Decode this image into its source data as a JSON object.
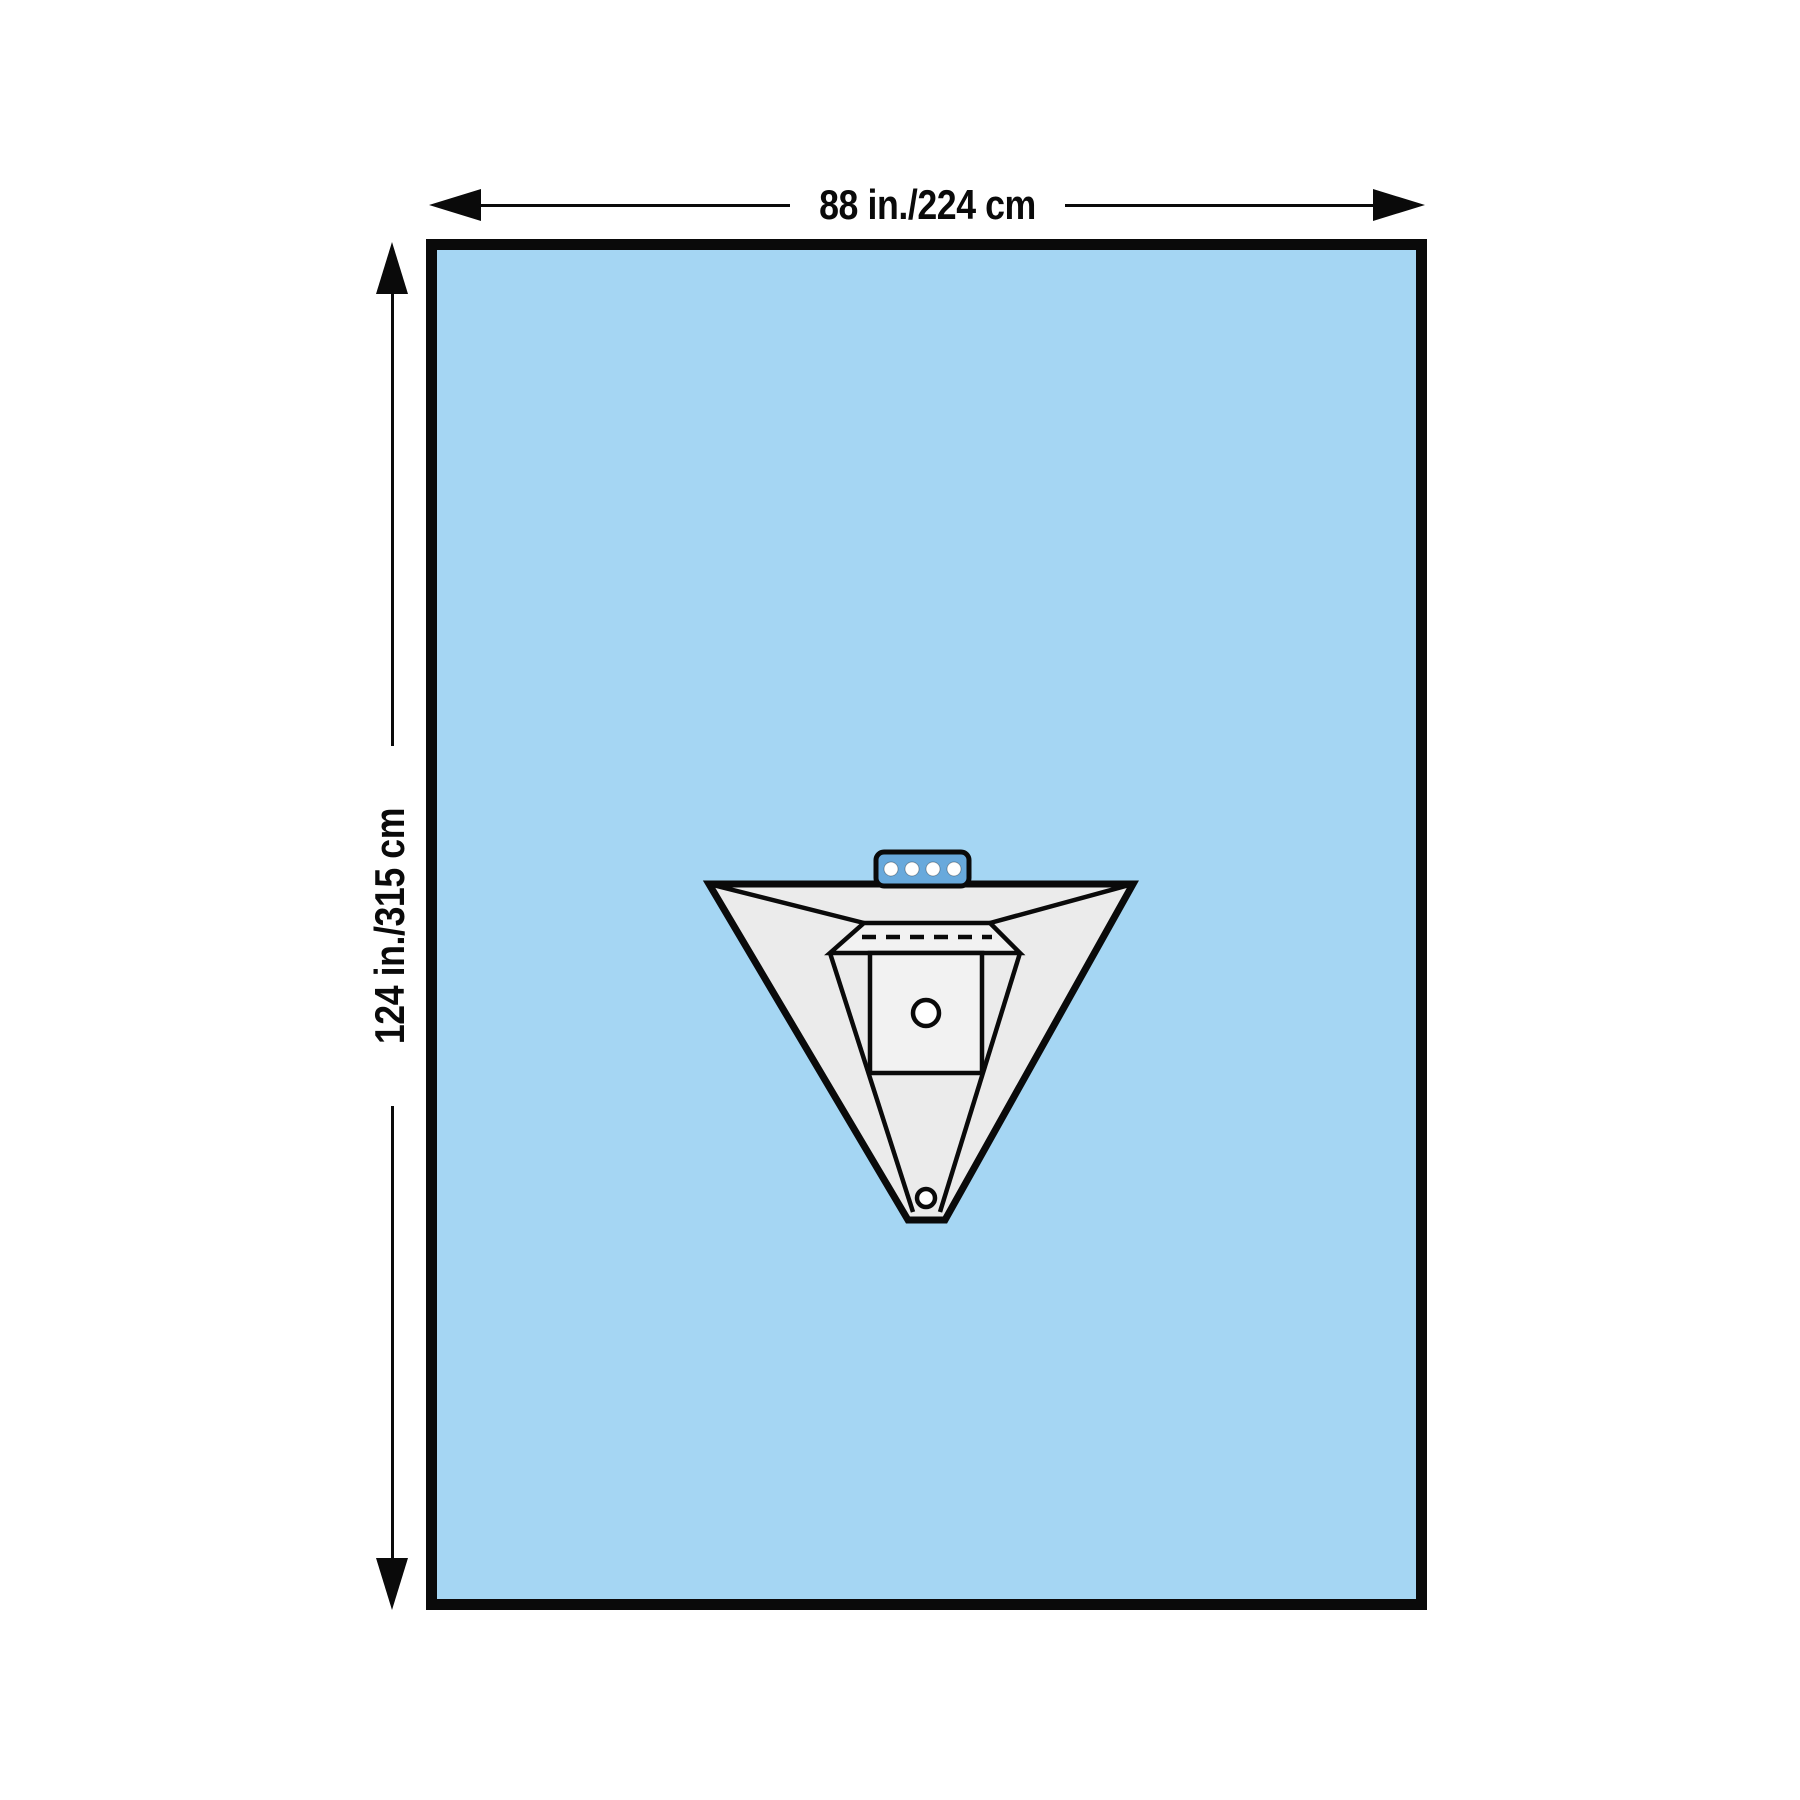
{
  "diagram": {
    "width_dimension_label": "88 in./224 cm",
    "height_dimension_label": "124 in./315 cm"
  },
  "icons": {
    "arrow-left": "left-filled-arrowhead",
    "arrow-right": "right-filled-arrowhead",
    "arrow-up": "up-filled-arrowhead",
    "arrow-down": "down-filled-arrowhead",
    "connector-tab": "blue-tab-with-four-holes",
    "fenestration-hole": "white-circle",
    "drain-port": "white-circle"
  },
  "colors": {
    "page-bg": "#ffffff",
    "drape-blue": "#a5d6f3",
    "tab-blue": "#68a9dc",
    "pouch-gray": "#ebebeb",
    "pouch-light": "#f2f2f2",
    "line-black": "#0a0a0a"
  }
}
